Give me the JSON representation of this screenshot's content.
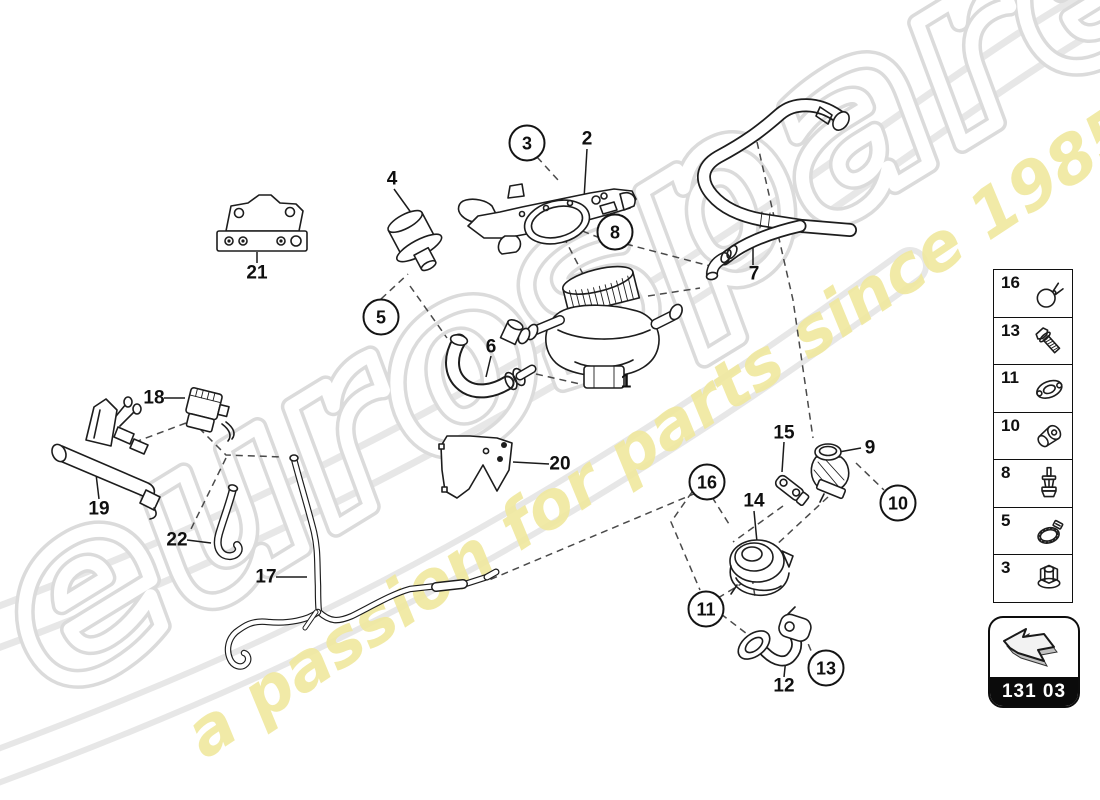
{
  "watermark": {
    "brand": "eurospares",
    "tagline": "a passion for parts since 1985",
    "tagline_color": "#f0e9a0"
  },
  "nav_box": {
    "code": "131 03",
    "icon": "back-arrow-icon"
  },
  "callouts": [
    {
      "num": "1",
      "x": 626,
      "y": 382,
      "circled": false
    },
    {
      "num": "2",
      "x": 587,
      "y": 139,
      "circled": false
    },
    {
      "num": "3",
      "x": 527,
      "y": 143,
      "circled": true
    },
    {
      "num": "4",
      "x": 392,
      "y": 179,
      "circled": false
    },
    {
      "num": "5",
      "x": 381,
      "y": 317,
      "circled": true
    },
    {
      "num": "6",
      "x": 491,
      "y": 347,
      "circled": false
    },
    {
      "num": "7",
      "x": 754,
      "y": 274,
      "circled": false
    },
    {
      "num": "8",
      "x": 615,
      "y": 232,
      "circled": true
    },
    {
      "num": "9",
      "x": 870,
      "y": 448,
      "circled": false
    },
    {
      "num": "10",
      "x": 898,
      "y": 503,
      "circled": true
    },
    {
      "num": "11",
      "x": 706,
      "y": 609,
      "circled": true
    },
    {
      "num": "12",
      "x": 784,
      "y": 686,
      "circled": false
    },
    {
      "num": "13",
      "x": 826,
      "y": 668,
      "circled": true
    },
    {
      "num": "14",
      "x": 754,
      "y": 501,
      "circled": false
    },
    {
      "num": "15",
      "x": 784,
      "y": 433,
      "circled": false
    },
    {
      "num": "16",
      "x": 707,
      "y": 482,
      "circled": true
    },
    {
      "num": "17",
      "x": 266,
      "y": 577,
      "circled": false
    },
    {
      "num": "18",
      "x": 154,
      "y": 398,
      "circled": false
    },
    {
      "num": "19",
      "x": 99,
      "y": 509,
      "circled": false
    },
    {
      "num": "20",
      "x": 560,
      "y": 464,
      "circled": false
    },
    {
      "num": "21",
      "x": 257,
      "y": 273,
      "circled": false
    },
    {
      "num": "22",
      "x": 177,
      "y": 540,
      "circled": false
    }
  ],
  "sidebar": {
    "items": [
      {
        "num": "16",
        "icon": "wire-clamp-icon"
      },
      {
        "num": "13",
        "icon": "hex-bolt-icon"
      },
      {
        "num": "11",
        "icon": "flange-gasket-icon"
      },
      {
        "num": "10",
        "icon": "sleeve-connector-icon"
      },
      {
        "num": "8",
        "icon": "expansion-rivet-icon"
      },
      {
        "num": "5",
        "icon": "hose-clamp-icon"
      },
      {
        "num": "3",
        "icon": "flange-nut-icon"
      }
    ]
  }
}
